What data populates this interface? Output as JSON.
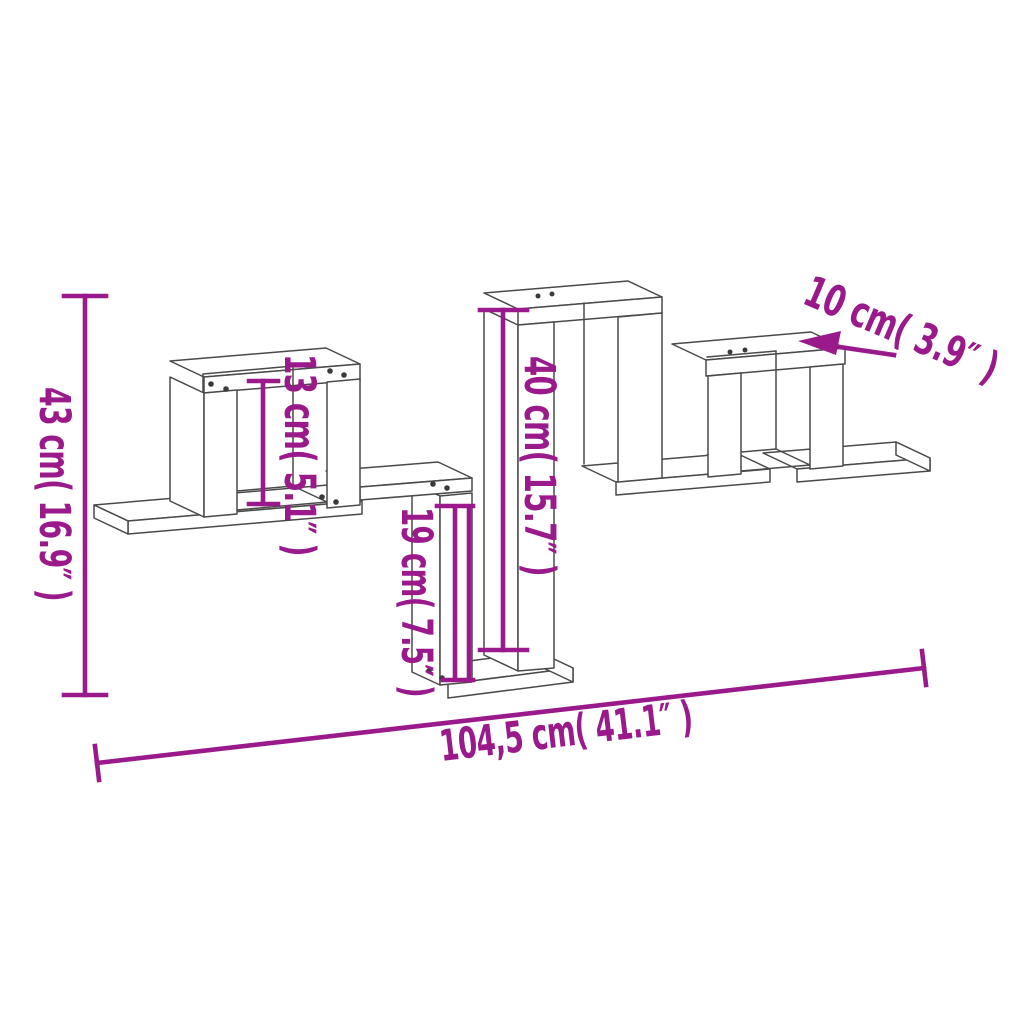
{
  "diagram": {
    "title": "wall-shelf-dimension-diagram",
    "dimensions": {
      "total_height": "43 cm( 16.9″ )",
      "cube_height": "13 cm( 5.1″ )",
      "tower_height": "40 cm( 15.7″ )",
      "drop_height": "19 cm( 7.5″ )",
      "depth": "10 cm( 3.9″ )",
      "total_width": "104,5 cm( 41.1″ )"
    },
    "colors": {
      "dimension": "#9a1a8c",
      "line_art": "#4a4a4a",
      "background": "#ffffff",
      "screw_dot": "#3a3a3a"
    }
  }
}
